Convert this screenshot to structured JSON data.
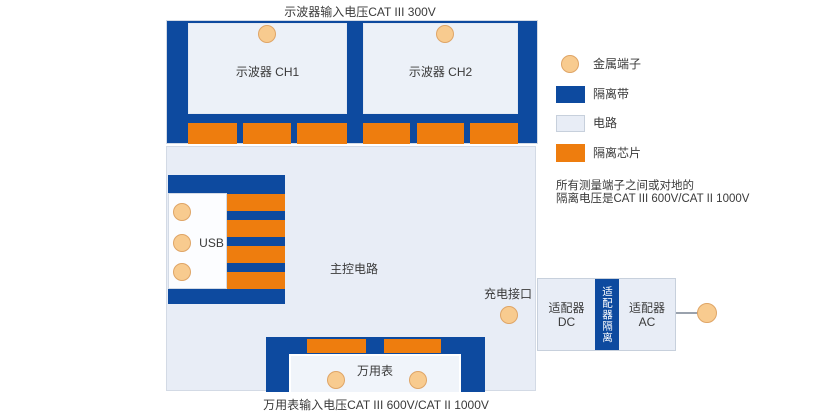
{
  "captions": {
    "top": "示波器输入电压CAT III 300V",
    "bottom": "万用表输入电压CAT III 600V/CAT II 1000V"
  },
  "scope": {
    "ch1": "示波器 CH1",
    "ch2": "示波器 CH2"
  },
  "main": {
    "usb": "USB",
    "controller": "主控电路",
    "charge_port": "充电接口",
    "multimeter": "万用表"
  },
  "adapter": {
    "dc_line1": "适配器",
    "dc_line2": "DC",
    "isolation": "适配器隔离",
    "ac_line1": "适配器",
    "ac_line2": "AC"
  },
  "legend": {
    "items": [
      {
        "label": "金属端子",
        "swatch": "metal-terminal",
        "color": "#f8cb8f"
      },
      {
        "label": "隔离带",
        "swatch": "isolation-band",
        "color": "#0d4a9f"
      },
      {
        "label": "电路",
        "swatch": "circuit",
        "color": "#e8edf6"
      },
      {
        "label": "隔离芯片",
        "swatch": "isolation-chip",
        "color": "#ee7d0e"
      }
    ],
    "note_line1": "所有测量端子之间或对地的",
    "note_line2": "隔离电压是CAT III 600V/CAT II 1000V"
  },
  "colors": {
    "isolation_blue": "#0d4a9f",
    "chip_orange": "#ee7d0e",
    "circuit_fill": "#e8edf6",
    "terminal_fill": "#f8cb8f"
  }
}
